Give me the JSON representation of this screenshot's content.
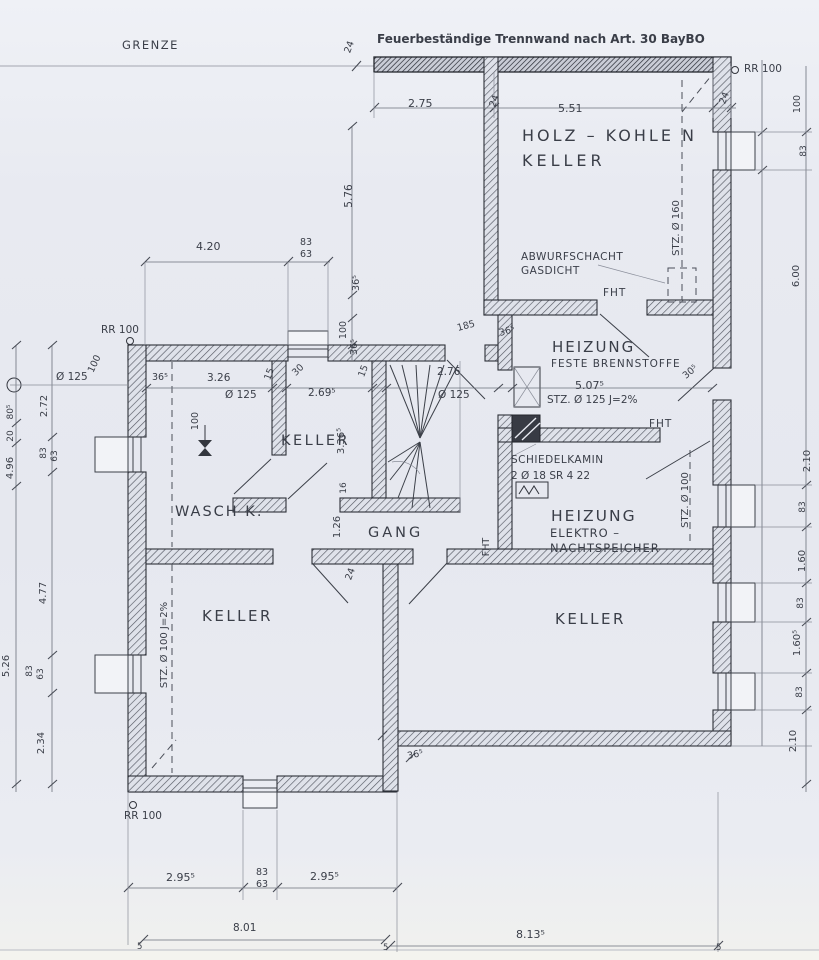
{
  "colors": {
    "paper": "#e8eaf1",
    "wall_hatch": "#4e525c",
    "ink": "#33363e",
    "dim_ink": "#6b707b"
  },
  "plan": {
    "boundary_note": "GRENZE",
    "firewall_note": "Feuerbeständige Trennwand nach Art. 30 BayBO",
    "rooms": [
      "HOLZ – KOHLE N KELLER",
      "HEIZUNG FESTE BRENNSTOFFE",
      "KELLER",
      "WASCH K.",
      "GANG",
      "HEIZUNG ELEKTRO-NACHTSPEICHER",
      "KELLER",
      "KELLER"
    ]
  },
  "labels": [
    {
      "n": "note-firewall",
      "t": "Feuerbeständige Trennwand nach Art. 30 BayBO",
      "x": 377,
      "y": 43,
      "s": 12,
      "b": 1
    },
    {
      "n": "label-grenze",
      "t": "GRENZE",
      "x": 122,
      "y": 49,
      "s": 11.5,
      "ls": 1.5
    },
    {
      "n": "dim-24-grenze",
      "t": "24",
      "x": 352,
      "y": 48,
      "r": -70,
      "s": 9.5,
      "a": "m"
    },
    {
      "n": "dim-2-75",
      "t": "2.75",
      "x": 408,
      "y": 107,
      "s": 11
    },
    {
      "n": "dim-24-top-a",
      "t": "24",
      "x": 497,
      "y": 102,
      "r": -70,
      "s": 9.5,
      "a": "m"
    },
    {
      "n": "dim-5-51",
      "t": "5.51",
      "x": 558,
      "y": 112,
      "s": 11
    },
    {
      "n": "dim-24-top-b",
      "t": "24",
      "x": 727,
      "y": 99,
      "r": -70,
      "s": 9.5,
      "a": "m"
    },
    {
      "n": "label-rr100-topright",
      "t": "RR 100",
      "x": 744,
      "y": 72,
      "s": 10.5
    },
    {
      "n": "room-label-holzkohlen-1",
      "t": "HOLZ – KOHLE N",
      "x": 522,
      "y": 141,
      "s": 16,
      "ls": 3
    },
    {
      "n": "room-label-holzkohlen-2",
      "t": "KELLER",
      "x": 522,
      "y": 166,
      "s": 16,
      "ls": 4
    },
    {
      "n": "label-stz-160",
      "t": "STZ. Ø 160",
      "x": 679,
      "y": 228,
      "r": -90,
      "s": 10,
      "a": "m"
    },
    {
      "n": "label-abwurfschacht-1",
      "t": "ABWURFSCHACHT",
      "x": 521,
      "y": 260,
      "s": 10.5,
      "ls": 0.5
    },
    {
      "n": "label-abwurfschacht-2",
      "t": "GASDICHT",
      "x": 521,
      "y": 274,
      "s": 10.5,
      "ls": 0.5
    },
    {
      "n": "label-fht-holzkeller",
      "t": "FHT",
      "x": 603,
      "y": 296,
      "s": 10.5,
      "ls": 1
    },
    {
      "n": "dim-4-20",
      "t": "4.20",
      "x": 196,
      "y": 250,
      "s": 11
    },
    {
      "n": "dim-83-top",
      "t": "83",
      "x": 300,
      "y": 245,
      "s": 9.5
    },
    {
      "n": "dim-63-top",
      "t": "63",
      "x": 300,
      "y": 257,
      "s": 9.5
    },
    {
      "n": "dim-5-76",
      "t": "5.76",
      "x": 352,
      "y": 196,
      "r": -90,
      "s": 10.5,
      "a": "m"
    },
    {
      "n": "dim-365-a",
      "t": "36⁵",
      "x": 359,
      "y": 283,
      "r": -90,
      "s": 9.5,
      "a": "m"
    },
    {
      "n": "dim-100-a",
      "t": "100",
      "x": 346,
      "y": 330,
      "r": -90,
      "s": 9.5,
      "a": "m"
    },
    {
      "n": "dim-365-b",
      "t": "36⁵",
      "x": 357,
      "y": 347,
      "r": -90,
      "s": 9.5,
      "a": "m"
    },
    {
      "n": "dim-185",
      "t": "185",
      "x": 458,
      "y": 331,
      "r": -15,
      "s": 9.5
    },
    {
      "n": "room-label-heizung-feste-1",
      "t": "HEIZUNG",
      "x": 552,
      "y": 352,
      "s": 15,
      "ls": 2
    },
    {
      "n": "room-label-heizung-feste-2",
      "t": "FESTE  BRENNSTOFFE",
      "x": 551,
      "y": 367,
      "s": 10.5,
      "ls": 1
    },
    {
      "n": "dim-365-heizung",
      "t": "36⁵",
      "x": 500,
      "y": 336,
      "r": -15,
      "s": 9.5
    },
    {
      "n": "dim-305-right",
      "t": "30⁵",
      "x": 692,
      "y": 374,
      "r": -40,
      "s": 9.5,
      "a": "m"
    },
    {
      "n": "label-rr100-left",
      "t": "RR 100",
      "x": 101,
      "y": 333,
      "s": 10.5
    },
    {
      "n": "dim-o125-left",
      "t": "Ø 125",
      "x": 56,
      "y": 380,
      "s": 10.5
    },
    {
      "n": "dim-100-leftwall",
      "t": "100",
      "x": 97,
      "y": 365,
      "r": -65,
      "s": 9.5,
      "a": "m"
    },
    {
      "n": "dim-chain-365",
      "t": "36⁵",
      "x": 152,
      "y": 380,
      "s": 9.5
    },
    {
      "n": "dim-3-26",
      "t": "3.26",
      "x": 207,
      "y": 381,
      "s": 10.5
    },
    {
      "n": "dim-o125-waschk",
      "t": "Ø 125",
      "x": 225,
      "y": 398,
      "s": 10.5
    },
    {
      "n": "dim-15-a",
      "t": "15",
      "x": 272,
      "y": 375,
      "r": -70,
      "s": 9.5,
      "a": "m"
    },
    {
      "n": "dim-30-diag",
      "t": "30",
      "x": 300,
      "y": 372,
      "r": -45,
      "s": 9.5,
      "a": "m"
    },
    {
      "n": "dim-2-695",
      "t": "2.69⁵",
      "x": 308,
      "y": 396,
      "s": 10.5
    },
    {
      "n": "dim-15-b",
      "t": "15",
      "x": 366,
      "y": 372,
      "r": -70,
      "s": 9.5,
      "a": "m"
    },
    {
      "n": "dim-2-76",
      "t": "2.76",
      "x": 437,
      "y": 375,
      "s": 10.5
    },
    {
      "n": "dim-o125-stair",
      "t": "Ø 125",
      "x": 438,
      "y": 398,
      "s": 10.5
    },
    {
      "n": "dim-5-075",
      "t": "5.07⁵",
      "x": 575,
      "y": 389,
      "s": 11
    },
    {
      "n": "label-stz-125",
      "t": "STZ. Ø 125  J=2%",
      "x": 547,
      "y": 403,
      "s": 10.5
    },
    {
      "n": "room-label-keller-small",
      "t": "KELLER",
      "x": 281,
      "y": 445,
      "s": 14.5,
      "ls": 2.5
    },
    {
      "n": "dim-3-365",
      "t": "3.36⁵",
      "x": 344,
      "y": 441,
      "r": -90,
      "s": 10,
      "a": "m"
    },
    {
      "n": "dim-100-waschk",
      "t": "100",
      "x": 198,
      "y": 421,
      "r": -90,
      "s": 9.5,
      "a": "m"
    },
    {
      "n": "dim-2-72",
      "t": "2.72",
      "x": 47,
      "y": 406,
      "r": -90,
      "s": 10,
      "a": "m"
    },
    {
      "n": "dim-83-left1",
      "t": "83",
      "x": 46,
      "y": 453,
      "r": -90,
      "s": 9,
      "a": "m"
    },
    {
      "n": "dim-63-left1",
      "t": "63",
      "x": 57,
      "y": 456,
      "r": -90,
      "s": 9,
      "a": "m"
    },
    {
      "n": "dim-805-left",
      "t": "80⁵",
      "x": 13,
      "y": 412,
      "r": -90,
      "s": 9,
      "a": "m"
    },
    {
      "n": "dim-20-left",
      "t": "20",
      "x": 13,
      "y": 436,
      "r": -90,
      "s": 9,
      "a": "m"
    },
    {
      "n": "dim-4-96",
      "t": "4.96",
      "x": 13,
      "y": 468,
      "r": -90,
      "s": 10,
      "a": "m"
    },
    {
      "n": "room-label-waschk",
      "t": "WASCH K.",
      "x": 175,
      "y": 516,
      "s": 14.5,
      "ls": 2
    },
    {
      "n": "dim-16",
      "t": "16",
      "x": 346,
      "y": 488,
      "r": -90,
      "s": 9,
      "a": "m"
    },
    {
      "n": "dim-1-26",
      "t": "1.26",
      "x": 340,
      "y": 527,
      "r": -90,
      "s": 10,
      "a": "m"
    },
    {
      "n": "room-label-gang",
      "t": "GANG",
      "x": 368,
      "y": 537,
      "s": 14.5,
      "ls": 3
    },
    {
      "n": "label-fht-gang",
      "t": "FHT",
      "x": 489,
      "y": 547,
      "r": -90,
      "s": 9.5,
      "a": "m"
    },
    {
      "n": "label-schiedelkamin-1",
      "t": "SCHIEDELKAMIN",
      "x": 511,
      "y": 463,
      "s": 10.5,
      "ls": 0.5
    },
    {
      "n": "label-schiedelkamin-2",
      "t": "2 Ø 18  SR 4 22",
      "x": 511,
      "y": 479,
      "s": 10.5
    },
    {
      "n": "label-fht-elektro",
      "t": "FHT",
      "x": 649,
      "y": 427,
      "s": 10.5,
      "ls": 1
    },
    {
      "n": "room-label-heizung-elektro-1",
      "t": "HEIZUNG",
      "x": 551,
      "y": 521,
      "s": 15.5,
      "ls": 2
    },
    {
      "n": "room-label-heizung-elektro-2",
      "t": "ELEKTRO –",
      "x": 550,
      "y": 537,
      "s": 11.5,
      "ls": 1
    },
    {
      "n": "room-label-heizung-elektro-3",
      "t": "NACHTSPEICHER",
      "x": 550,
      "y": 552,
      "s": 11.5,
      "ls": 1
    },
    {
      "n": "label-stz-100-elektro",
      "t": "STZ. Ø 100",
      "x": 688,
      "y": 500,
      "r": -90,
      "s": 10,
      "a": "m"
    },
    {
      "n": "dim-24-gang",
      "t": "24",
      "x": 353,
      "y": 575,
      "r": -70,
      "s": 9.5,
      "a": "m"
    },
    {
      "n": "room-label-keller-left",
      "t": "KELLER",
      "x": 202,
      "y": 621,
      "s": 15,
      "ls": 2.5
    },
    {
      "n": "room-label-keller-right",
      "t": "KELLER",
      "x": 555,
      "y": 624,
      "s": 15,
      "ls": 2.5
    },
    {
      "n": "label-stz-100-keller",
      "t": "STZ. Ø 100  J=2%",
      "x": 167,
      "y": 645,
      "r": -90,
      "s": 10,
      "a": "m"
    },
    {
      "n": "dim-4-77",
      "t": "4.77",
      "x": 46,
      "y": 593,
      "r": -90,
      "s": 10,
      "a": "m"
    },
    {
      "n": "dim-83-left2",
      "t": "83",
      "x": 32,
      "y": 671,
      "r": -90,
      "s": 9,
      "a": "m"
    },
    {
      "n": "dim-63-left2",
      "t": "63",
      "x": 43,
      "y": 674,
      "r": -90,
      "s": 9,
      "a": "m"
    },
    {
      "n": "dim-5-26",
      "t": "5.26",
      "x": 9,
      "y": 666,
      "r": -90,
      "s": 10,
      "a": "m"
    },
    {
      "n": "dim-2-34",
      "t": "2.34",
      "x": 44,
      "y": 743,
      "r": -90,
      "s": 10,
      "a": "m"
    },
    {
      "n": "dim-365-step",
      "t": "36⁵",
      "x": 408,
      "y": 759,
      "r": -12,
      "s": 9.5
    },
    {
      "n": "label-rr100-bottomleft",
      "t": "RR 100",
      "x": 124,
      "y": 819,
      "s": 10.5
    },
    {
      "n": "dim-2-955-a",
      "t": "2.95⁵",
      "x": 166,
      "y": 881,
      "s": 11
    },
    {
      "n": "dim-83-bottom",
      "t": "83",
      "x": 256,
      "y": 875,
      "s": 9.5
    },
    {
      "n": "dim-63-bottom",
      "t": "63",
      "x": 256,
      "y": 887,
      "s": 9.5
    },
    {
      "n": "dim-2-955-b",
      "t": "2.95⁵",
      "x": 310,
      "y": 880,
      "s": 11
    },
    {
      "n": "dim-8-01",
      "t": "8.01",
      "x": 233,
      "y": 931,
      "s": 10.5
    },
    {
      "n": "dim-8-135",
      "t": "8.13⁵",
      "x": 516,
      "y": 938,
      "s": 11
    },
    {
      "n": "dim-5-tick-1",
      "t": "5",
      "x": 137,
      "y": 949,
      "s": 8.5
    },
    {
      "n": "dim-5-tick-2",
      "t": "5",
      "x": 383,
      "y": 950,
      "s": 8.5
    },
    {
      "n": "dim-5-tick-3",
      "t": "5",
      "x": 716,
      "y": 950,
      "s": 8.5
    },
    {
      "n": "dim-right-100",
      "t": "100",
      "x": 800,
      "y": 104,
      "r": -90,
      "s": 9.5,
      "a": "m"
    },
    {
      "n": "dim-right-83a",
      "t": "83",
      "x": 806,
      "y": 151,
      "r": -90,
      "s": 9,
      "a": "m"
    },
    {
      "n": "dim-right-600",
      "t": "6.00",
      "x": 799,
      "y": 276,
      "r": -90,
      "s": 10,
      "a": "m"
    },
    {
      "n": "dim-right-210a",
      "t": "2.10",
      "x": 810,
      "y": 461,
      "r": -90,
      "s": 10,
      "a": "m"
    },
    {
      "n": "dim-right-83b",
      "t": "83",
      "x": 805,
      "y": 507,
      "r": -90,
      "s": 9,
      "a": "m"
    },
    {
      "n": "dim-right-160",
      "t": "1.60",
      "x": 805,
      "y": 561,
      "r": -90,
      "s": 10,
      "a": "m"
    },
    {
      "n": "dim-right-83c",
      "t": "83",
      "x": 803,
      "y": 603,
      "r": -90,
      "s": 9,
      "a": "m"
    },
    {
      "n": "dim-right-1605",
      "t": "1.60⁵",
      "x": 800,
      "y": 643,
      "r": -90,
      "s": 10,
      "a": "m"
    },
    {
      "n": "dim-right-83d",
      "t": "83",
      "x": 802,
      "y": 692,
      "r": -90,
      "s": 9,
      "a": "m"
    },
    {
      "n": "dim-right-210b",
      "t": "2.10",
      "x": 796,
      "y": 741,
      "r": -90,
      "s": 10,
      "a": "m"
    }
  ]
}
